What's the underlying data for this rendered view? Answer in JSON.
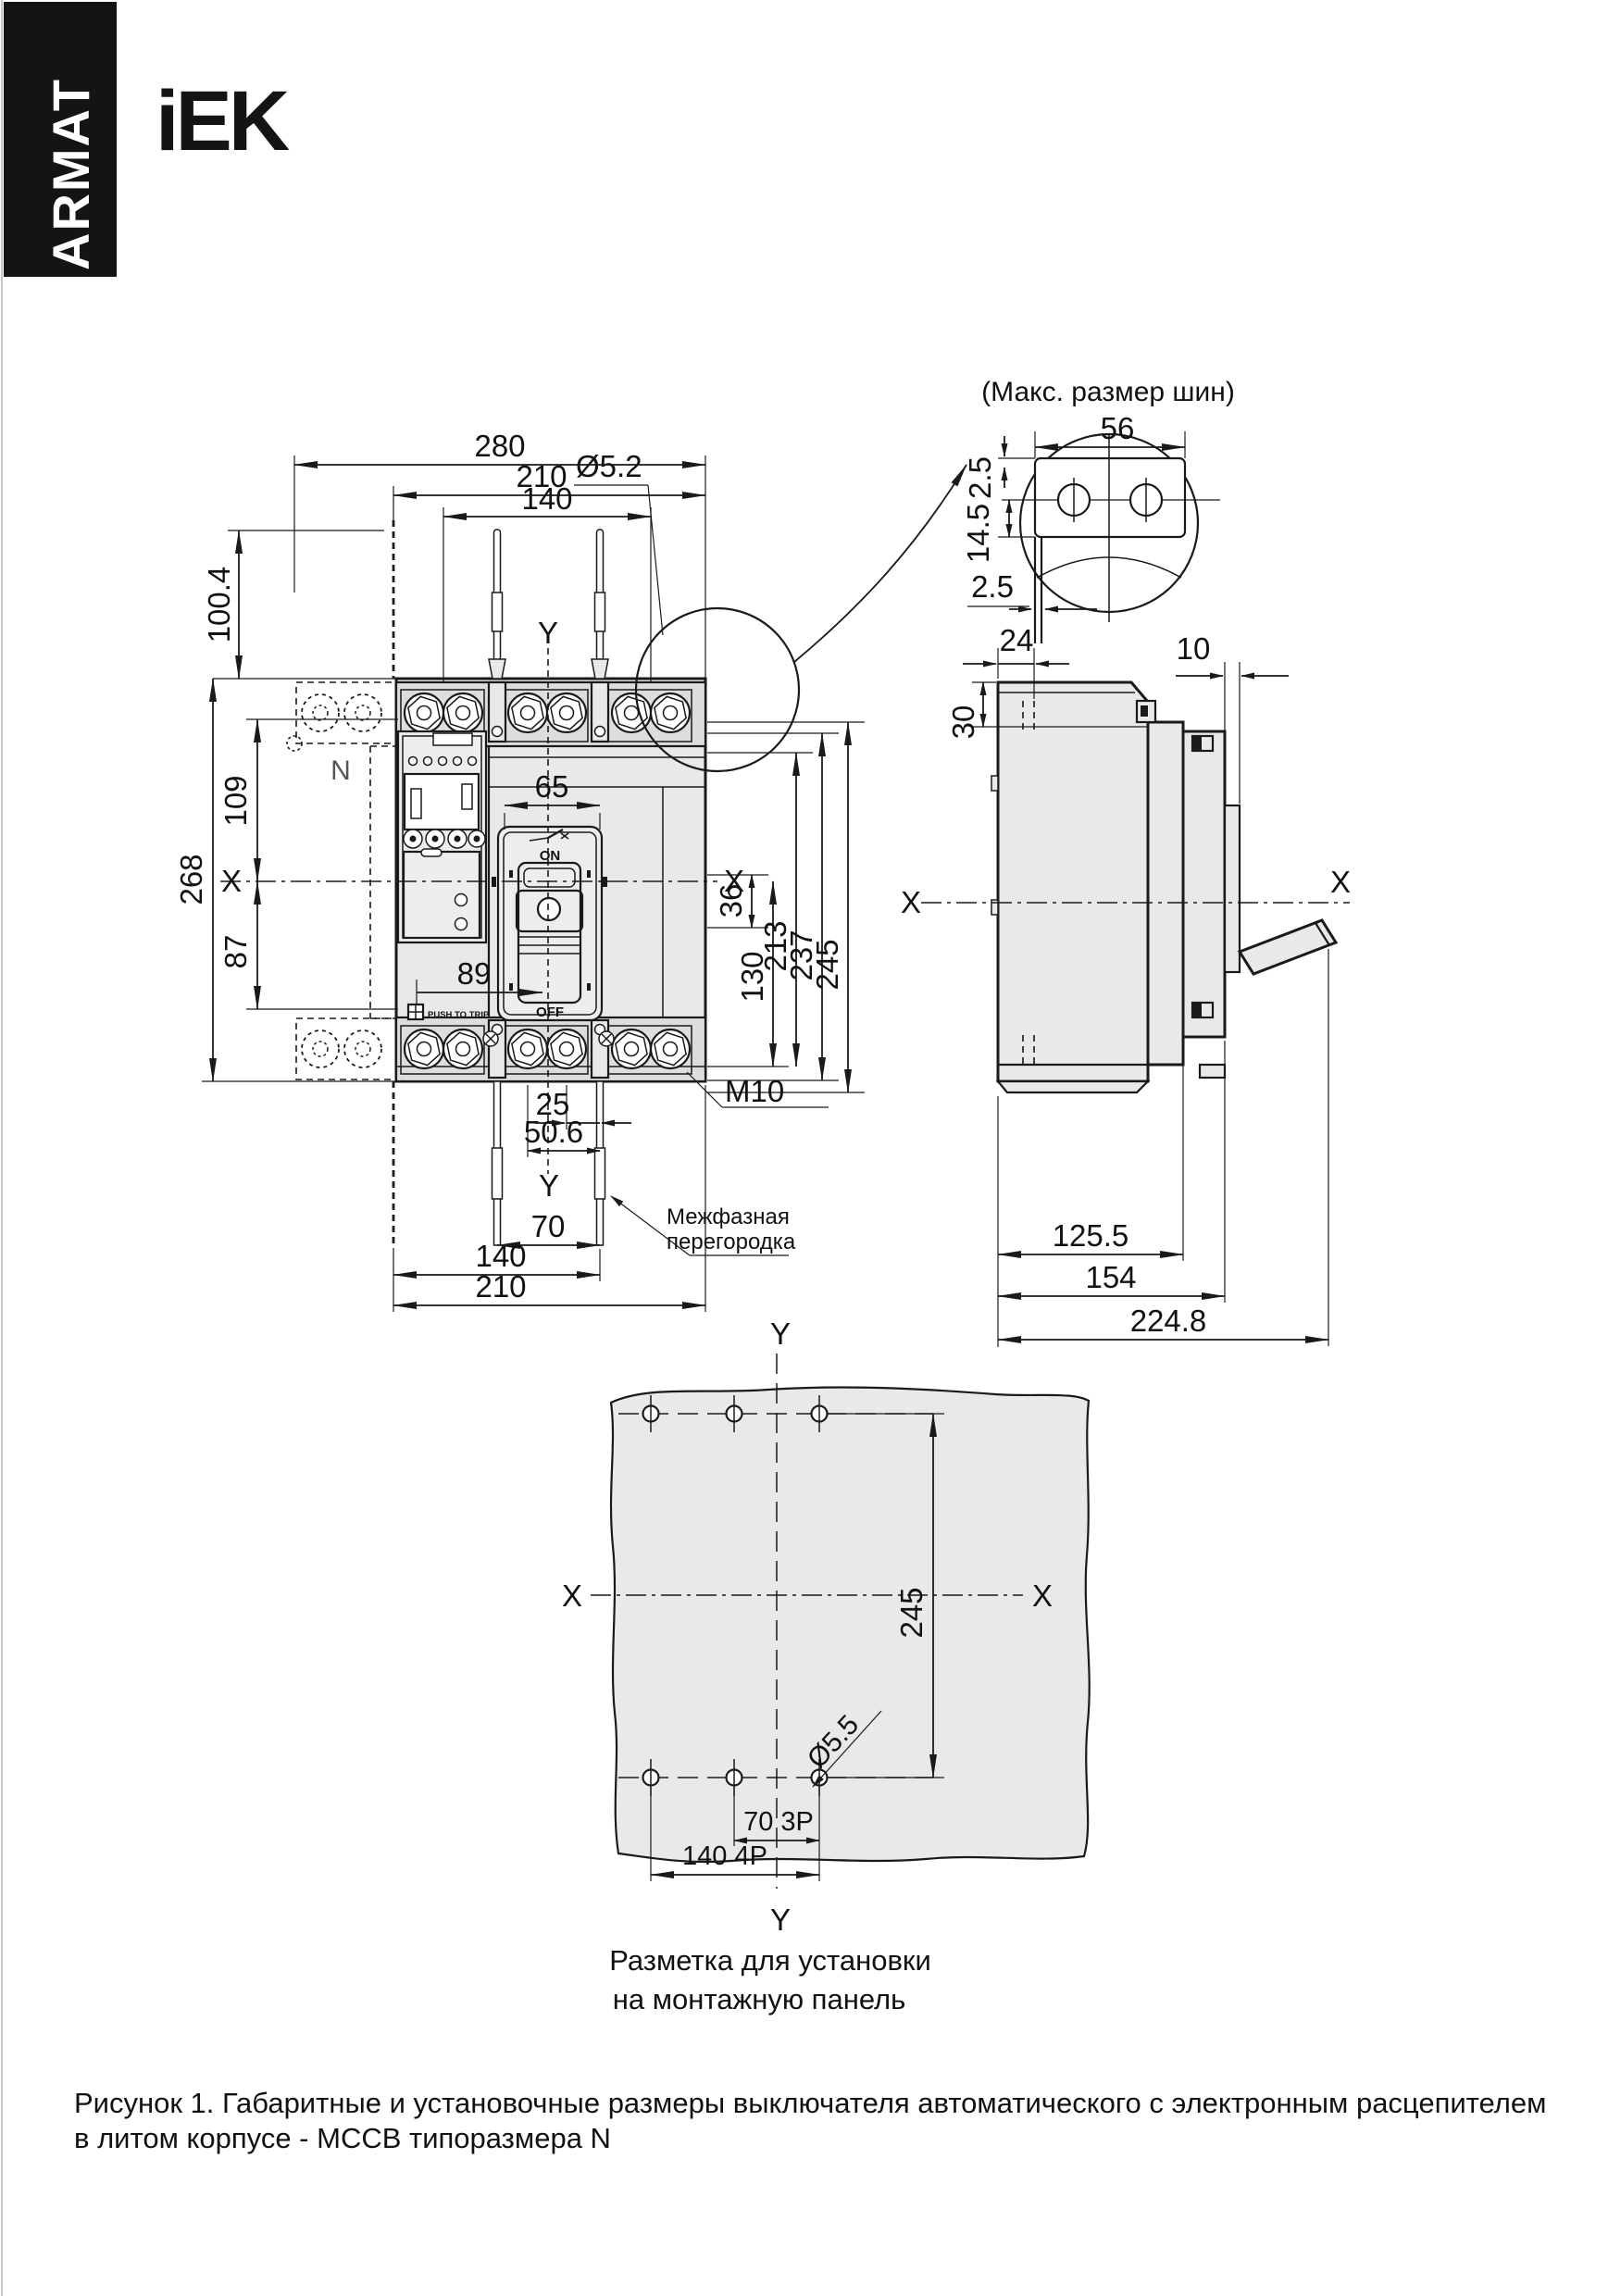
{
  "page": {
    "brand": "ARMAT",
    "logo": "iEK",
    "caption_line1": "Рисунок 1. Габаритные и установочные размеры выключателя автоматического с электронным расцепителем",
    "caption_line2": "в литом корпусе - MCCB типоразмера N"
  },
  "front": {
    "d280": "280",
    "d210": "210",
    "d140": "140",
    "d100_4": "100.4",
    "d268": "268",
    "d109": "109",
    "d87": "87",
    "d65": "65",
    "d89": "89",
    "d36": "36",
    "d130": "130",
    "d213": "213",
    "d237": "237",
    "d245": "245",
    "d25": "25",
    "d50_6": "50.6",
    "d70": "70",
    "d140b": "140",
    "d210b": "210",
    "dia52": "Ø5.2",
    "m10": "M10",
    "pole_n": "N",
    "on": "ON",
    "off": "OFF",
    "push": "PUSH TO TRIP",
    "interphase1": "Межфазная",
    "interphase2": "перегородка",
    "x_left": "X",
    "x_right": "X",
    "y_top": "Y",
    "y_bottom": "Y"
  },
  "detail": {
    "title": "(Макс. размер шин)",
    "d56": "56",
    "d2_5t": "2.5",
    "d14_5": "14.5",
    "d2_5b": "2.5"
  },
  "side": {
    "d24": "24",
    "d30": "30",
    "d10": "10",
    "d125_5": "125.5",
    "d154": "154",
    "d224_8": "224.8",
    "x_left": "X",
    "x_right": "X"
  },
  "mount": {
    "d245": "245",
    "d70_3p": "70 3P",
    "d140_4p": "140 4P",
    "dia55": "Ø5.5",
    "x_left": "X",
    "x_right": "X",
    "y_top": "Y",
    "y_bottom": "Y",
    "caption1": "Разметка для установки",
    "caption2": "на монтажную панель"
  }
}
